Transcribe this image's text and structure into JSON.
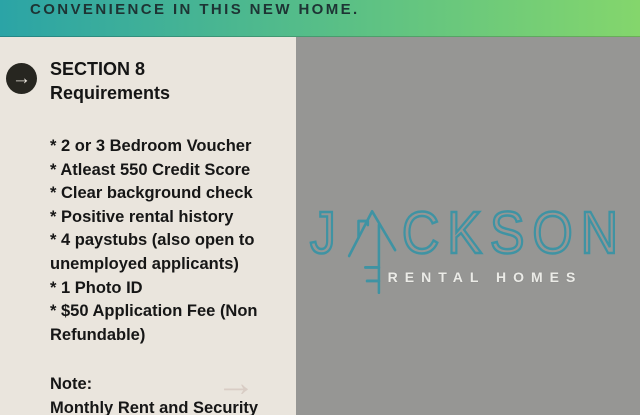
{
  "banner": {
    "text": "CONVENIENCE IN THIS NEW HOME."
  },
  "left_panel": {
    "heading": {
      "line1": "SECTION 8",
      "line2": "Requirements"
    },
    "items": [
      "* 2 or 3 Bedroom Voucher",
      "* Atleast 550 Credit Score",
      "* Clear background check",
      "* Positive rental history",
      "* 4 paystubs (also open to unemployed applicants)",
      "* 1 Photo ID",
      "* $50 Application Fee (Non Refundable)"
    ],
    "note_label": "Note:",
    "note_text": "Monthly Rent and Security"
  },
  "logo": {
    "letters_before": "J",
    "letters_after": "CKSON",
    "subtitle": "RENTAL HOMES"
  },
  "icons": {
    "circle_arrow": "→",
    "faint_arrow": "→"
  },
  "colors": {
    "banner_teal": "#2ba4a6",
    "banner_green": "#84d66c",
    "banner_text": "#1e3434",
    "left_panel_bg": "#eae5dd",
    "right_panel_bg": "#969694",
    "body_text": "#161616",
    "logo_teal": "#3f93a3",
    "logo_subtitle": "#ebebe7"
  }
}
